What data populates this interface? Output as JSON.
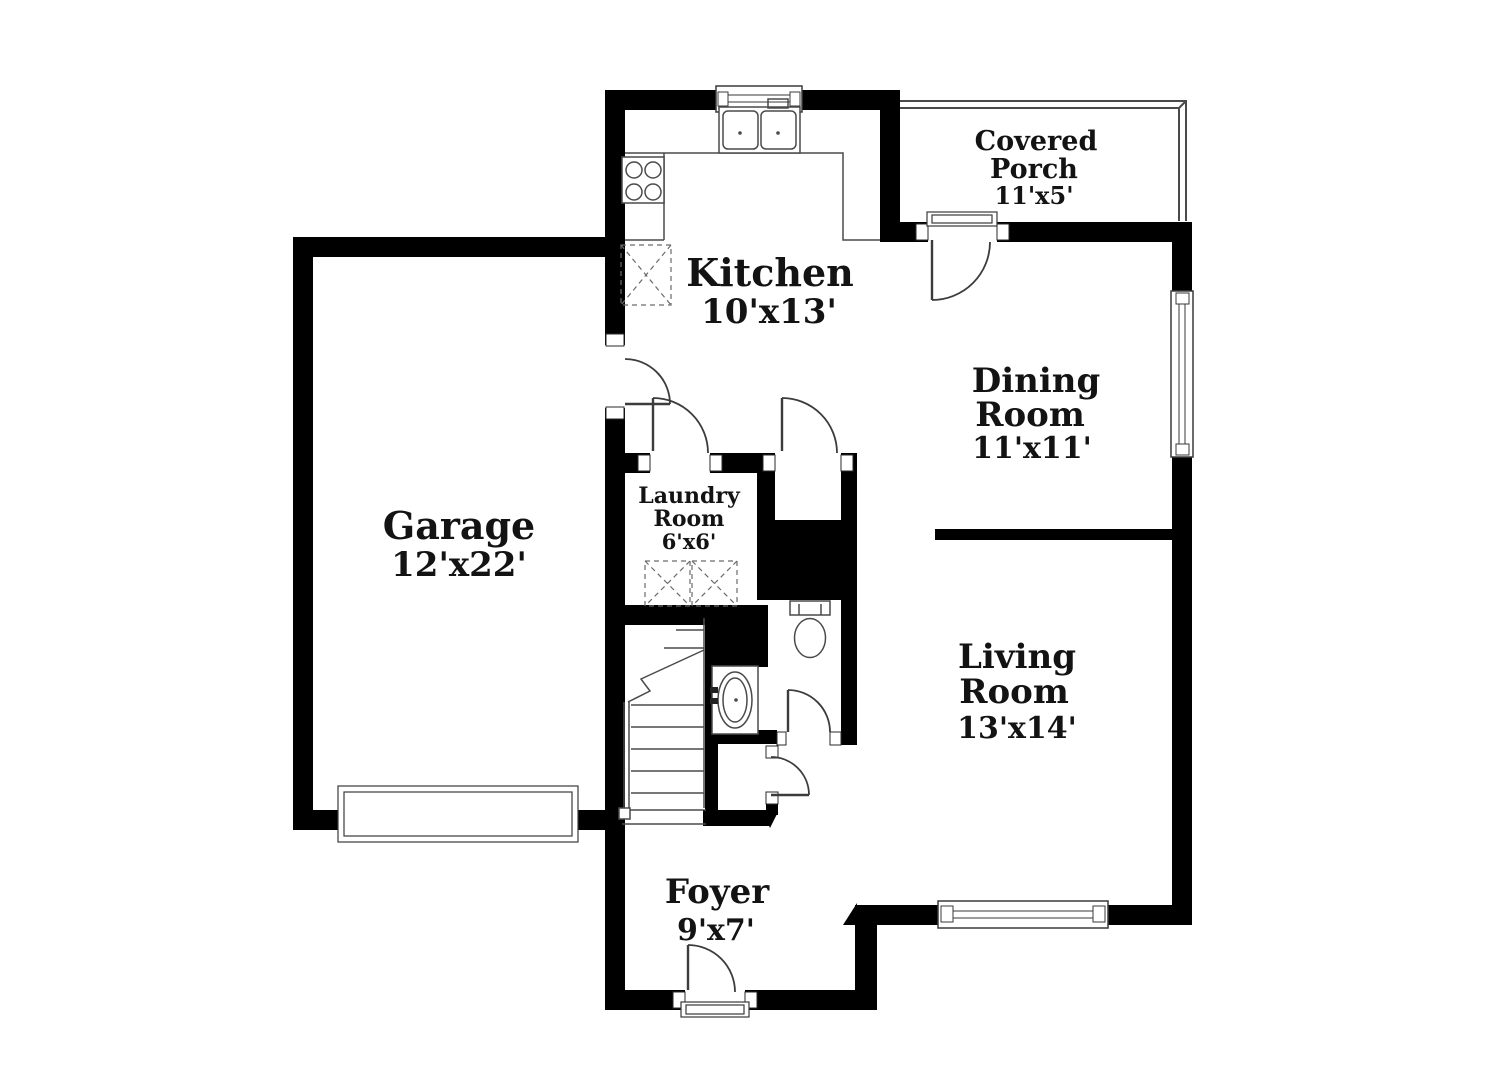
{
  "rooms": {
    "kitchen": {
      "name": "Kitchen",
      "dims": "10'x13'"
    },
    "covered_porch": {
      "line1": "Covered",
      "line2": "Porch",
      "dims": "11'x5'"
    },
    "dining_room": {
      "line1": "Dining",
      "line2": "Room",
      "dims": "11'x11'"
    },
    "garage": {
      "name": "Garage",
      "dims": "12'x22'"
    },
    "laundry_room": {
      "line1": "Laundry",
      "line2": "Room",
      "dims": "6'x6'"
    },
    "living_room": {
      "line1": "Living",
      "line2": "Room",
      "dims": "13'x14'"
    },
    "foyer": {
      "name": "Foyer",
      "dims": "9'x7'"
    }
  },
  "colors": {
    "wall": "#000000",
    "background": "#ffffff",
    "fixture_line": "#4a4a4a"
  },
  "fixtures": [
    "double-sink",
    "stove-cooktop",
    "pantry",
    "washer",
    "dryer",
    "stairs",
    "toilet",
    "vanity-sink",
    "garage-door",
    "front-door",
    "porch-door",
    "kitchen-window",
    "dining-window",
    "living-window"
  ]
}
